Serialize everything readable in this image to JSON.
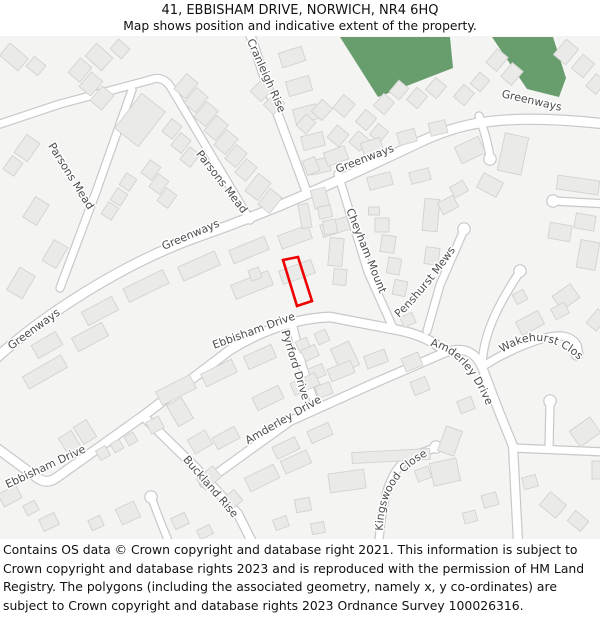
{
  "header": {
    "title": "41, EBBISHAM DRIVE, NORWICH, NR4 6HQ",
    "subtitle": "Map shows position and indicative extent of the property."
  },
  "footer": {
    "text": "Contains OS data © Crown copyright and database right 2021. This information is subject to Crown copyright and database rights 2023 and is reproduced with the permission of HM Land Registry. The polygons (including the associated geometry, namely x, y co-ordinates) are subject to Crown copyright and database rights 2023 Ordnance Survey 100026316."
  },
  "map": {
    "colors": {
      "background": "#f4f4f2",
      "road_fill": "#ffffff",
      "road_casing": "#c8c8c8",
      "building_fill": "#eaeae8",
      "building_stroke": "#d2d2d0",
      "green": "#689e6d",
      "label": "#4c4c4c",
      "property": "#ee0000"
    },
    "green_areas": [
      "340,37 450,37 453,68 378,97",
      "492,37 553,37 566,78 559,97 527,89"
    ],
    "roads": [
      {
        "d": "M -6,360 C 40,318 120,264 200,236 C 280,208 340,180 420,142 C 458,124 500,112 606,124",
        "w": 9
      },
      {
        "d": "M 60,288 L 96,192 L 132,90",
        "w": 7
      },
      {
        "d": "M -6,126 L 60,104 L 150,80",
        "w": 7
      },
      {
        "d": "M 150,80 Q 162,75 170,86 L 250,220",
        "w": 7
      },
      {
        "d": "M 250,34 L 268,88 L 306,190",
        "w": 8
      },
      {
        "d": "M 479,116 Q 487,138 490,157",
        "w": 7
      },
      {
        "d": "M 338,174 L 368,272 L 394,330",
        "w": 7
      },
      {
        "d": "M -6,446 L 36,477 Q 46,485 56,478 L 143,416 L 230,350 Q 280,319 330,317 L 398,330 Q 428,336 446,352",
        "w": 8.5
      },
      {
        "d": "M 464,230 L 440,285 L 427,331",
        "w": 7
      },
      {
        "d": "M 204,483 L 290,421 L 370,385 L 446,352 Q 472,344 482,367 L 500,414 L 513,446 L 518,542",
        "w": 8
      },
      {
        "d": "M 482,367 C 506,351 546,334 562,336 C 576,338 580,347 577,355",
        "w": 7
      },
      {
        "d": "M 482,366 C 483,336 496,308 519,273",
        "w": 7
      },
      {
        "d": "M 608,204 L 554,201",
        "w": 7
      },
      {
        "d": "M 513,448 L 606,452",
        "w": 7
      },
      {
        "d": "M 549,449 L 550,402",
        "w": 7
      },
      {
        "d": "M 379,542 C 382,498 390,468 412,456 L 435,448",
        "w": 7
      },
      {
        "d": "M 143,416 L 196,468 L 238,514 L 252,542",
        "w": 8
      },
      {
        "d": "M 168,540 Q 158,516 152,499",
        "w": 6.5
      },
      {
        "d": "M 292,322 L 302,365 L 315,404",
        "w": 7
      }
    ],
    "bulbs": [
      [
        490,
        159
      ],
      [
        464,
        229
      ],
      [
        577,
        354
      ],
      [
        520,
        271
      ],
      [
        553,
        201
      ],
      [
        550,
        401
      ],
      [
        436,
        447
      ],
      [
        151,
        497
      ]
    ],
    "buildings": [
      [
        14,
        57,
        24,
        16,
        40
      ],
      [
        36,
        66,
        15,
        13,
        40
      ],
      [
        99,
        57,
        22,
        17,
        42
      ],
      [
        120,
        49,
        15,
        13,
        42
      ],
      [
        80,
        70,
        15,
        19,
        40
      ],
      [
        91,
        84,
        15,
        19,
        40
      ],
      [
        102,
        98,
        15,
        19,
        40
      ],
      [
        27,
        148,
        16,
        22,
        35
      ],
      [
        13,
        166,
        13,
        16,
        35
      ],
      [
        36,
        211,
        16,
        24,
        32
      ],
      [
        55,
        254,
        16,
        24,
        30
      ],
      [
        21,
        283,
        18,
        26,
        30
      ],
      [
        140,
        120,
        30,
        44,
        38
      ],
      [
        172,
        129,
        13,
        16,
        38
      ],
      [
        181,
        143,
        13,
        16,
        38
      ],
      [
        190,
        157,
        13,
        16,
        38
      ],
      [
        151,
        170,
        13,
        16,
        36
      ],
      [
        159,
        184,
        13,
        16,
        36
      ],
      [
        167,
        198,
        13,
        16,
        36
      ],
      [
        128,
        182,
        12,
        14,
        33
      ],
      [
        119,
        197,
        12,
        14,
        33
      ],
      [
        110,
        211,
        12,
        14,
        33
      ],
      [
        186,
        86,
        15,
        20,
        40
      ],
      [
        196,
        100,
        15,
        20,
        40
      ],
      [
        206,
        114,
        15,
        20,
        40
      ],
      [
        216,
        128,
        15,
        20,
        40
      ],
      [
        226,
        142,
        15,
        20,
        40
      ],
      [
        236,
        156,
        14,
        18,
        40
      ],
      [
        246,
        170,
        14,
        18,
        40
      ],
      [
        262,
        90,
        15,
        18,
        45
      ],
      [
        274,
        104,
        14,
        16,
        45
      ],
      [
        258,
        187,
        16,
        22,
        38
      ],
      [
        270,
        201,
        15,
        20,
        38
      ],
      [
        292,
        57,
        15,
        24,
        72
      ],
      [
        299,
        86,
        15,
        24,
        74
      ],
      [
        306,
        114,
        15,
        24,
        75
      ],
      [
        313,
        141,
        14,
        22,
        76
      ],
      [
        320,
        166,
        14,
        20,
        78
      ],
      [
        306,
        124,
        13,
        15,
        42
      ],
      [
        322,
        110,
        14,
        16,
        42
      ],
      [
        344,
        106,
        15,
        17,
        40
      ],
      [
        366,
        120,
        14,
        16,
        40
      ],
      [
        384,
        104,
        14,
        16,
        40
      ],
      [
        399,
        90,
        13,
        15,
        40
      ],
      [
        417,
        98,
        14,
        16,
        40
      ],
      [
        436,
        88,
        14,
        16,
        40
      ],
      [
        338,
        136,
        15,
        16,
        40
      ],
      [
        359,
        141,
        14,
        15,
        40
      ],
      [
        379,
        133,
        13,
        14,
        40
      ],
      [
        464,
        95,
        14,
        16,
        40
      ],
      [
        480,
        82,
        13,
        15,
        40
      ],
      [
        497,
        60,
        14,
        18,
        40
      ],
      [
        512,
        74,
        14,
        18,
        40
      ],
      [
        566,
        52,
        16,
        20,
        40
      ],
      [
        583,
        66,
        15,
        18,
        40
      ],
      [
        596,
        84,
        13,
        16,
        40
      ],
      [
        311,
        166,
        13,
        15,
        -22
      ],
      [
        336,
        156,
        22,
        14,
        -20
      ],
      [
        372,
        147,
        20,
        14,
        -18
      ],
      [
        407,
        137,
        18,
        13,
        -16
      ],
      [
        438,
        128,
        17,
        13,
        -14
      ],
      [
        470,
        150,
        18,
        26,
        65
      ],
      [
        490,
        185,
        22,
        16,
        28
      ],
      [
        513,
        154,
        24,
        38,
        12
      ],
      [
        578,
        185,
        42,
        14,
        8
      ],
      [
        585,
        222,
        20,
        15,
        10
      ],
      [
        560,
        232,
        22,
        16,
        10
      ],
      [
        588,
        255,
        19,
        28,
        10
      ],
      [
        566,
        297,
        17,
        22,
        55
      ],
      [
        597,
        320,
        13,
        18,
        40
      ],
      [
        100,
        311,
        34,
        15,
        -28
      ],
      [
        146,
        286,
        44,
        15,
        -26
      ],
      [
        199,
        266,
        40,
        15,
        -24
      ],
      [
        249,
        250,
        38,
        14,
        -22
      ],
      [
        295,
        237,
        32,
        14,
        -20
      ],
      [
        335,
        227,
        28,
        13,
        -18
      ],
      [
        47,
        345,
        28,
        15,
        -30
      ],
      [
        90,
        337,
        34,
        15,
        -28
      ],
      [
        45,
        372,
        44,
        14,
        -30
      ],
      [
        252,
        285,
        40,
        15,
        -22
      ],
      [
        297,
        272,
        34,
        14,
        -20
      ],
      [
        255,
        274,
        11,
        11,
        -20
      ],
      [
        176,
        390,
        38,
        15,
        -27
      ],
      [
        219,
        373,
        34,
        14,
        -26
      ],
      [
        260,
        357,
        30,
        14,
        -24
      ],
      [
        303,
        345,
        12,
        12,
        -24
      ],
      [
        322,
        337,
        12,
        12,
        -24
      ],
      [
        320,
        198,
        15,
        19,
        -15
      ],
      [
        325,
        212,
        13,
        12,
        -12
      ],
      [
        330,
        227,
        13,
        14,
        -10
      ],
      [
        336,
        252,
        14,
        28,
        5
      ],
      [
        340,
        277,
        13,
        16,
        5
      ],
      [
        305,
        216,
        10,
        24,
        -10
      ],
      [
        380,
        181,
        24,
        13,
        -15
      ],
      [
        420,
        176,
        20,
        12,
        -15
      ],
      [
        382,
        225,
        14,
        14,
        0
      ],
      [
        374,
        211,
        11,
        8,
        0
      ],
      [
        388,
        244,
        14,
        17,
        8
      ],
      [
        394,
        266,
        13,
        16,
        10
      ],
      [
        400,
        288,
        13,
        15,
        12
      ],
      [
        431,
        215,
        15,
        32,
        5
      ],
      [
        432,
        256,
        14,
        17,
        8
      ],
      [
        448,
        205,
        13,
        17,
        62
      ],
      [
        459,
        189,
        12,
        15,
        60
      ],
      [
        408,
        320,
        13,
        11,
        -24
      ],
      [
        412,
        362,
        18,
        14,
        -22
      ],
      [
        310,
        353,
        12,
        15,
        65
      ],
      [
        317,
        372,
        12,
        15,
        68
      ],
      [
        324,
        390,
        12,
        15,
        70
      ],
      [
        345,
        357,
        20,
        26,
        -25
      ],
      [
        70,
        443,
        15,
        20,
        -32
      ],
      [
        85,
        432,
        15,
        20,
        -32
      ],
      [
        103,
        453,
        11,
        11,
        -30
      ],
      [
        117,
        446,
        10,
        10,
        -30
      ],
      [
        131,
        439,
        10,
        10,
        -30
      ],
      [
        10,
        496,
        20,
        14,
        -28
      ],
      [
        31,
        508,
        13,
        11,
        -28
      ],
      [
        49,
        522,
        17,
        13,
        -26
      ],
      [
        96,
        523,
        13,
        11,
        -25
      ],
      [
        128,
        513,
        20,
        17,
        -25
      ],
      [
        155,
        425,
        14,
        13,
        -28
      ],
      [
        180,
        412,
        17,
        24,
        -30
      ],
      [
        200,
        442,
        20,
        16,
        -30
      ],
      [
        226,
        438,
        25,
        13,
        -28
      ],
      [
        209,
        478,
        14,
        21,
        50
      ],
      [
        231,
        501,
        14,
        19,
        50
      ],
      [
        268,
        398,
        29,
        14,
        -26
      ],
      [
        305,
        384,
        27,
        13,
        -24
      ],
      [
        341,
        371,
        25,
        13,
        -22
      ],
      [
        376,
        359,
        22,
        13,
        -20
      ],
      [
        286,
        448,
        25,
        13,
        -26
      ],
      [
        320,
        433,
        23,
        13,
        -24
      ],
      [
        262,
        478,
        32,
        15,
        -26
      ],
      [
        296,
        462,
        28,
        14,
        -24
      ],
      [
        391,
        456,
        78,
        11,
        -3
      ],
      [
        347,
        481,
        36,
        19,
        -8
      ],
      [
        303,
        505,
        15,
        13,
        -10
      ],
      [
        318,
        528,
        13,
        11,
        -10
      ],
      [
        281,
        523,
        14,
        11,
        -20
      ],
      [
        445,
        472,
        27,
        23,
        -12
      ],
      [
        466,
        405,
        15,
        13,
        -20
      ],
      [
        450,
        441,
        17,
        26,
        20
      ],
      [
        423,
        474,
        14,
        12,
        -20
      ],
      [
        420,
        386,
        16,
        14,
        -22
      ],
      [
        530,
        323,
        25,
        15,
        -28
      ],
      [
        560,
        311,
        15,
        12,
        -28
      ],
      [
        520,
        297,
        12,
        11,
        -28
      ],
      [
        553,
        505,
        21,
        17,
        40
      ],
      [
        578,
        521,
        17,
        13,
        40
      ],
      [
        585,
        432,
        25,
        19,
        -35
      ],
      [
        598,
        470,
        12,
        18,
        0
      ],
      [
        530,
        482,
        14,
        12,
        -15
      ],
      [
        490,
        500,
        15,
        13,
        -15
      ],
      [
        470,
        517,
        13,
        11,
        -15
      ],
      [
        180,
        521,
        15,
        12,
        -25
      ],
      [
        205,
        532,
        14,
        10,
        -25
      ]
    ],
    "labels": [
      {
        "text": "Cranleigh Rise",
        "x": 263,
        "y": 77,
        "rot": 66
      },
      {
        "text": "Greenways",
        "x": 531,
        "y": 104,
        "rot": 13
      },
      {
        "text": "Greenways",
        "x": 366,
        "y": 162,
        "rot": -21
      },
      {
        "text": "Greenways",
        "x": 192,
        "y": 238,
        "rot": -23
      },
      {
        "text": "Greenways",
        "x": 36,
        "y": 332,
        "rot": -36
      },
      {
        "text": "Parsons Mead",
        "x": 68,
        "y": 178,
        "rot": 58
      },
      {
        "text": "Parsons Mead",
        "x": 219,
        "y": 184,
        "rot": 52
      },
      {
        "text": "Cheyham Mount",
        "x": 363,
        "y": 252,
        "rot": 68
      },
      {
        "text": "Penshurst Mews",
        "path": "M 399,318 Q 430,288 458,246"
      },
      {
        "text": "Ebbisham Drive",
        "x": 255,
        "y": 334,
        "rot": -20
      },
      {
        "text": "Ebbisham Drive",
        "x": 47,
        "y": 470,
        "rot": -25
      },
      {
        "text": "Pyrford Drive",
        "x": 292,
        "y": 366,
        "rot": 73
      },
      {
        "text": "Amderley Drive",
        "x": 285,
        "y": 423,
        "rot": -30
      },
      {
        "text": "Amderley Drive",
        "path": "M 430,346 Q 466,352 490,414"
      },
      {
        "text": "Wakehurst Close",
        "path": "M 502,353 Q 543,325 581,362"
      },
      {
        "text": "Kingswood Close",
        "path": "M 383,531 Q 383,470 443,449"
      },
      {
        "text": "Buckland Rise",
        "x": 208,
        "y": 489,
        "rot": 49
      }
    ],
    "property_outline": {
      "points": "283,260 298,257 312,301 297,306"
    }
  }
}
